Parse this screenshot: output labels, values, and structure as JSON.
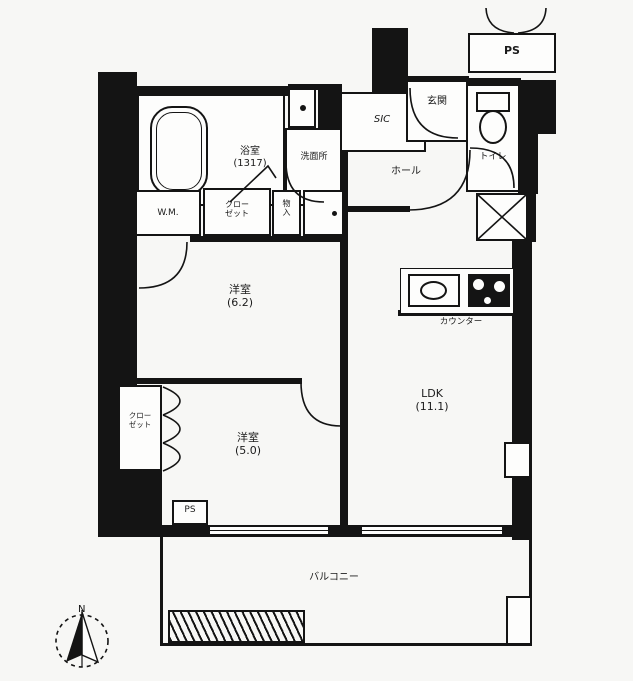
{
  "title": "apartment-floor-plan",
  "colors": {
    "wall": "#141414",
    "paper": "#f7f7f5",
    "room": "#fdfdfc"
  },
  "compass": {
    "north": "N"
  },
  "rooms": {
    "bath": {
      "name": "浴室",
      "size": "(1317)"
    },
    "washroom": {
      "name": "洗面所"
    },
    "sic": {
      "name": "SIC"
    },
    "entrance": {
      "name": "玄関"
    },
    "toilet": {
      "name": "トイレ"
    },
    "hall": {
      "name": "ホール"
    },
    "ps_top": {
      "name": "PS"
    },
    "ps_lower": {
      "name": "PS"
    },
    "wm": {
      "name": "W.M."
    },
    "closet_upper": {
      "line1": "クロー",
      "line2": "ゼット"
    },
    "storage": {
      "line1": "物",
      "line2": "入"
    },
    "bedroom_a": {
      "name": "洋室",
      "size": "(6.2)"
    },
    "bedroom_b": {
      "name": "洋室",
      "size": "(5.0)"
    },
    "closet_left": {
      "line1": "クロー",
      "line2": "ゼット"
    },
    "ldk": {
      "name": "LDK",
      "size": "(11.1)"
    },
    "counter": {
      "name": "カウンター"
    },
    "balcony": {
      "name": "バルコニー"
    }
  }
}
